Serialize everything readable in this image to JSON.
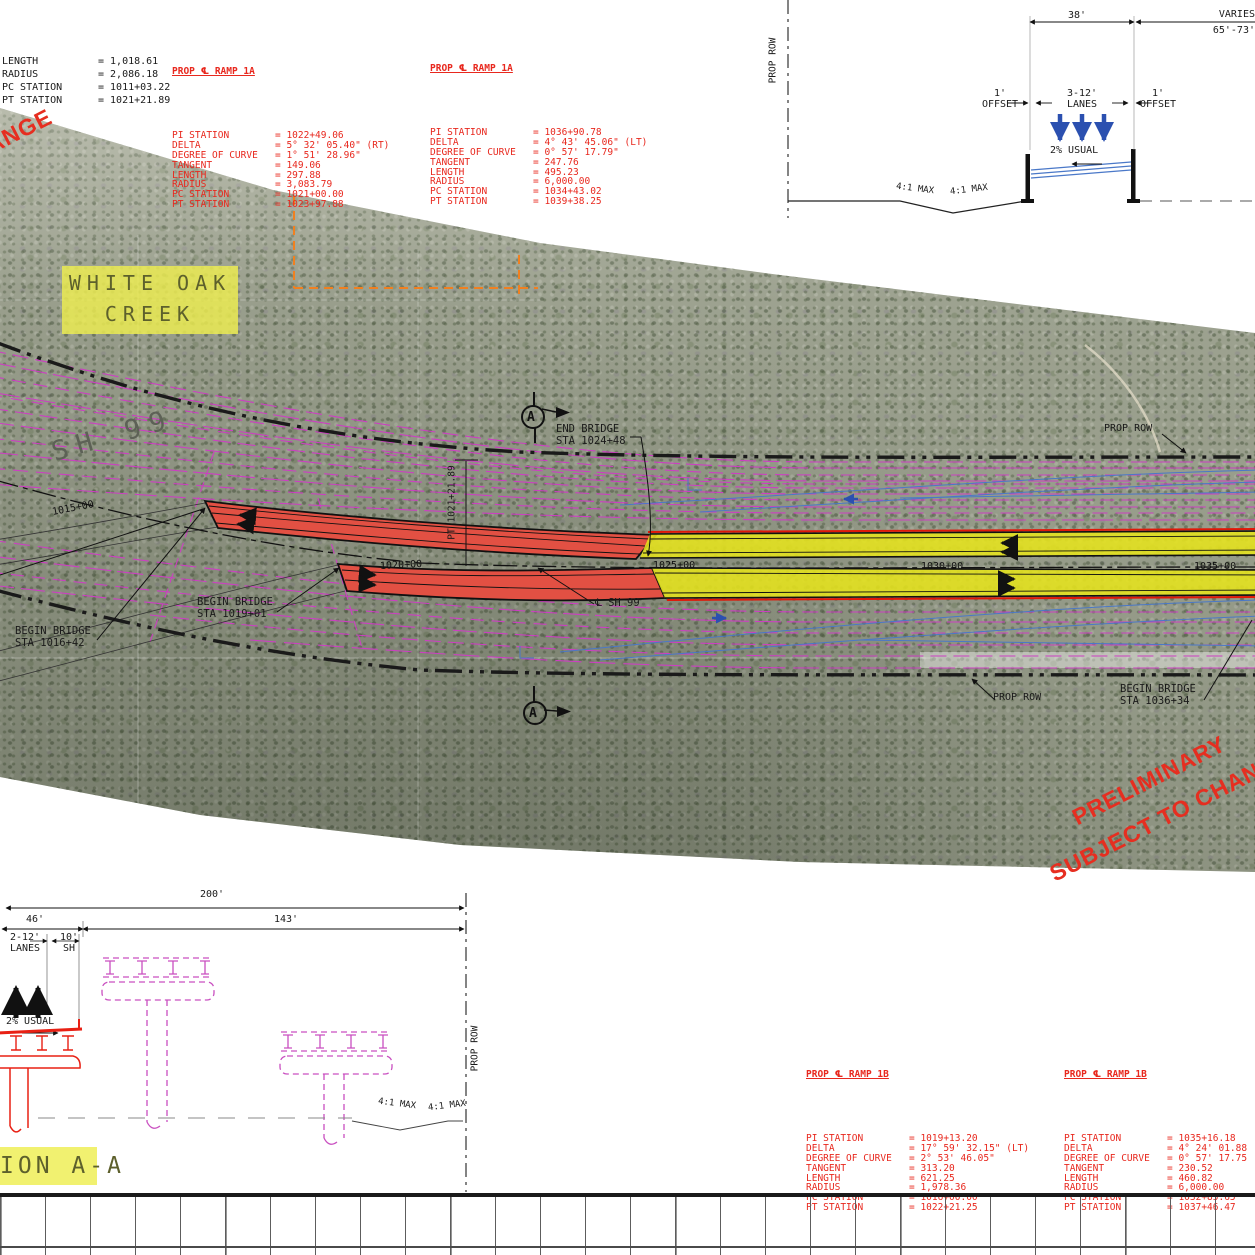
{
  "colors": {
    "table_red": "#e8281e",
    "stamp_red": "#e62e20",
    "magenta": "#cc3fc2",
    "yellow_highlight": "#e6e41c",
    "bridge_red": "#e25043",
    "blue": "#4a78c8",
    "black": "#1a1a1a",
    "creek_bg": "#eeee50",
    "aerial_base": "#9da290",
    "orange_dash": "#f08020"
  },
  "top_left_table": {
    "rows": [
      {
        "l": "LENGTH",
        "v": "= 1,018.61"
      },
      {
        "l": "RADIUS",
        "v": "= 2,086.18"
      },
      {
        "l": "PC STATION",
        "v": "= 1011+03.22"
      },
      {
        "l": "PT STATION",
        "v": "= 1021+21.89"
      }
    ]
  },
  "curve_tables": {
    "ramp1a_west": {
      "title": "PROP ℄ RAMP 1A",
      "rows": [
        {
          "l": "PI STATION",
          "v": "= 1022+49.06"
        },
        {
          "l": "DELTA",
          "v": "= 5° 32' 05.40\" (RT)"
        },
        {
          "l": "DEGREE OF CURVE",
          "v": "= 1° 51' 28.96\""
        },
        {
          "l": "TANGENT",
          "v": "= 149.06"
        },
        {
          "l": "LENGTH",
          "v": "= 297.88"
        },
        {
          "l": "RADIUS",
          "v": "= 3,083.79"
        },
        {
          "l": "PC STATION",
          "v": "= 1021+00.00"
        },
        {
          "l": "PT STATION",
          "v": "= 1023+97.88"
        }
      ]
    },
    "ramp1a_east": {
      "title": "PROP ℄ RAMP 1A",
      "rows": [
        {
          "l": "PI STATION",
          "v": "= 1036+90.78"
        },
        {
          "l": "DELTA",
          "v": "= 4° 43' 45.06\" (LT)"
        },
        {
          "l": "DEGREE OF CURVE",
          "v": "= 0° 57' 17.79\""
        },
        {
          "l": "TANGENT",
          "v": "= 247.76"
        },
        {
          "l": "LENGTH",
          "v": "= 495.23"
        },
        {
          "l": "RADIUS",
          "v": "= 6,000.00"
        },
        {
          "l": "PC STATION",
          "v": "= 1034+43.02"
        },
        {
          "l": "PT STATION",
          "v": "= 1039+38.25"
        }
      ]
    },
    "ramp1b_west": {
      "title": "PROP ℄ RAMP 1B",
      "rows": [
        {
          "l": "PI STATION",
          "v": "= 1019+13.20"
        },
        {
          "l": "DELTA",
          "v": "= 17° 59' 32.15\" (LT)"
        },
        {
          "l": "DEGREE OF CURVE",
          "v": "= 2° 53' 46.05\""
        },
        {
          "l": "TANGENT",
          "v": "= 313.20"
        },
        {
          "l": "LENGTH",
          "v": "= 621.25"
        },
        {
          "l": "RADIUS",
          "v": "= 1,978.36"
        },
        {
          "l": "PC STATION",
          "v": "= 1016+00.00"
        },
        {
          "l": "PT STATION",
          "v": "= 1022+21.25"
        }
      ]
    },
    "ramp1b_east": {
      "title": "PROP ℄ RAMP 1B",
      "rows": [
        {
          "l": "PI STATION",
          "v": "= 1035+16.18"
        },
        {
          "l": "DELTA",
          "v": "= 4° 24' 01.88"
        },
        {
          "l": "DEGREE OF CURVE",
          "v": "= 0° 57' 17.75"
        },
        {
          "l": "TANGENT",
          "v": "= 230.52"
        },
        {
          "l": "LENGTH",
          "v": "= 460.82"
        },
        {
          "l": "RADIUS",
          "v": "= 6,000.00"
        },
        {
          "l": "PC STATION",
          "v": "= 1032+85.65"
        },
        {
          "l": "PT STATION",
          "v": "= 1037+46.47"
        }
      ]
    }
  },
  "plan": {
    "creek_label": "WHITE OAK\nCREEK",
    "highway_label": "SH 99",
    "stations": [
      "1015+00",
      "1020+00",
      "1025+00",
      "1030+00",
      "1035+00"
    ],
    "begin_bridge_w1": "BEGIN BRIDGE\nSTA 1016+42",
    "begin_bridge_w2": "BEGIN BRIDGE\nSTA 1019+01",
    "end_bridge": "END BRIDGE\nSTA 1024+48",
    "begin_bridge_e": "BEGIN BRIDGE\nSTA 1036+34",
    "cl_label": "℄ SH 99",
    "pt_label": "PT 1021+21.89",
    "prop_row": "PROP ROW",
    "section_letter": "A"
  },
  "cross_section": {
    "dim_38": "38'",
    "varies": "VARIES",
    "varies_range": "65'-73'",
    "offset_left": "1'\nOFFSET",
    "lanes": "3-12'\nLANES",
    "offset_right": "1'\nOFFSET",
    "slope": "2% USUAL",
    "slope_max": "4:1 MAX",
    "prop_row": "PROP ROW"
  },
  "section_aa": {
    "dim_200": "200'",
    "dim_46": "46'",
    "dim_143": "143'",
    "lanes": "2-12'\nLANES",
    "shoulder": "10'\nSH",
    "slope": "2% USUAL",
    "slope_max": "4:1 MAX",
    "prop_row": "PROP ROW",
    "title": "ION A-A"
  },
  "stamps": {
    "line1": "PRELIMINARY",
    "line2": "SUBJECT TO CHANGE",
    "corner_fragment": "ANGE"
  }
}
